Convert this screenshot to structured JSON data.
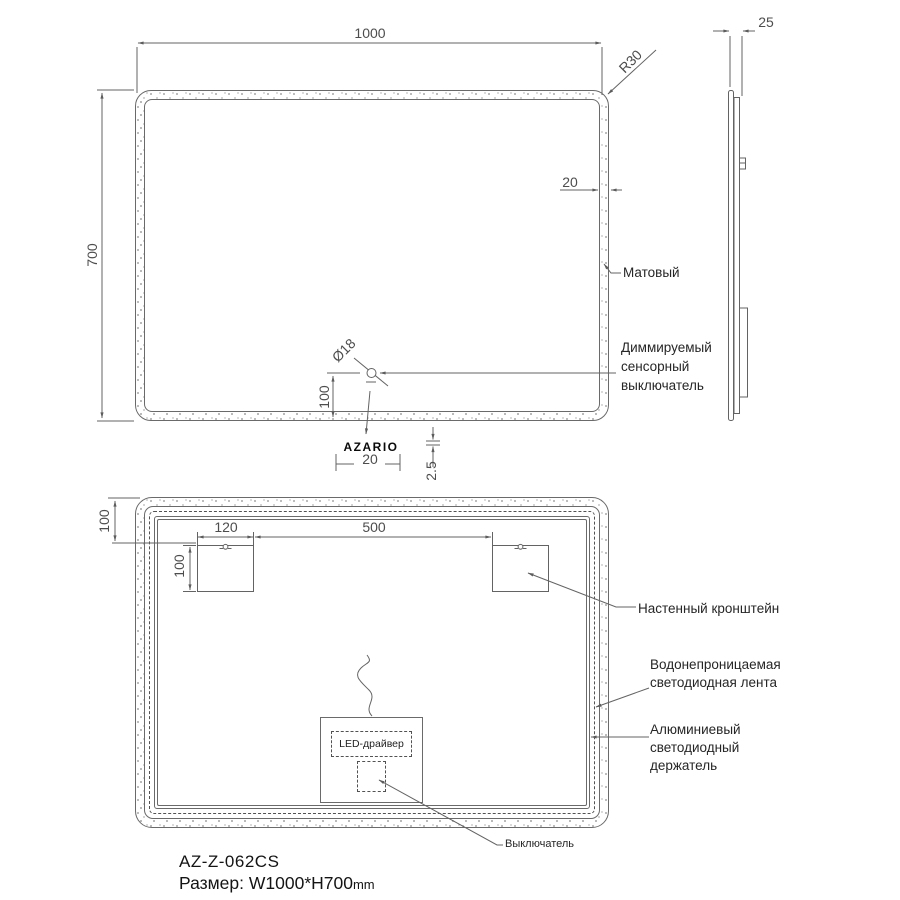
{
  "front": {
    "width": "1000",
    "height": "700",
    "corner_radius": "R30",
    "frame_width": "20",
    "matte_label": "Матовый",
    "sensor_diameter": "Ø18",
    "sensor_offset": "100",
    "sensor_label": "Диммируемый сенсорный выключатель",
    "logo": "AZARIO",
    "logo_width": "20",
    "logo_gap": "2.5"
  },
  "side": {
    "depth": "25"
  },
  "rear": {
    "top_offset": "100",
    "bracket_width": "120",
    "bracket_spacing": "500",
    "bracket_height": "100",
    "bracket_label": "Настенный кронштейн",
    "strip_label": "Водонепроницаемая светодиодная лента",
    "holder_label": "Алюминиевый светодиодный держатель",
    "driver_label": "LED-драйвер",
    "switch_label": "Выключатель"
  },
  "footer": {
    "model": "AZ-Z-062CS",
    "size": "Размер: W1000*H700",
    "unit": "mm"
  },
  "colors": {
    "line": "#636363",
    "text": "#262626"
  }
}
